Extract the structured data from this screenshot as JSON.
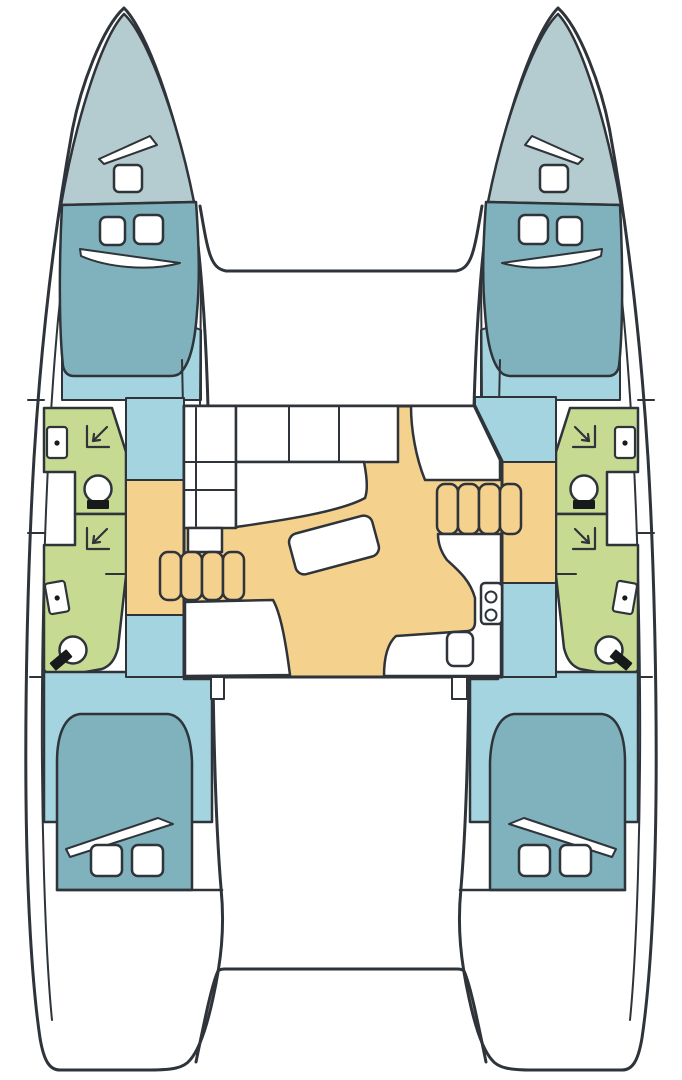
{
  "diagram": {
    "type": "boat-floorplan",
    "subject": "catamaran accommodation layout, top view",
    "orientation": "bow at top, stern at bottom"
  },
  "colors": {
    "outline": "#2e3439",
    "hull": "#ffffff",
    "bow_deck": "#b4cccf",
    "berth_teal": "#7fb2bd",
    "floor_blue": "#a4d4e0",
    "bathroom_green": "#c6da92",
    "salon_yellow": "#f5d18e",
    "fixture_dark": "#17191a",
    "background": "#ffffff"
  },
  "layout": {
    "hulls": [
      {
        "side": "port",
        "areas": [
          "bow-locker-deck",
          "forward-double-cabin",
          "forward-bathroom-shower",
          "aft-bathroom-shower",
          "aft-double-cabin"
        ]
      },
      {
        "side": "starboard",
        "areas": [
          "bow-locker-deck",
          "forward-double-cabin",
          "forward-bathroom-shower",
          "aft-bathroom-shower",
          "aft-double-cabin"
        ]
      }
    ],
    "bridgedeck": [
      "foredeck",
      "salon-settee-and-table",
      "galley-sink-and-stove",
      "companionway-steps-each-hull",
      "aft-cockpit-platform"
    ]
  },
  "features": {
    "hulls": 2,
    "cabins": 4,
    "double_berths": 4,
    "bathrooms": 4,
    "showers": 4,
    "toilets": 4,
    "washbasins": 4,
    "deck_hatches": 2,
    "berth_pillows": 8,
    "salon_tables": 1,
    "step_flights": 2,
    "steps_per_flight": 4,
    "stove_burners": 2,
    "galley_sinks": 1
  }
}
